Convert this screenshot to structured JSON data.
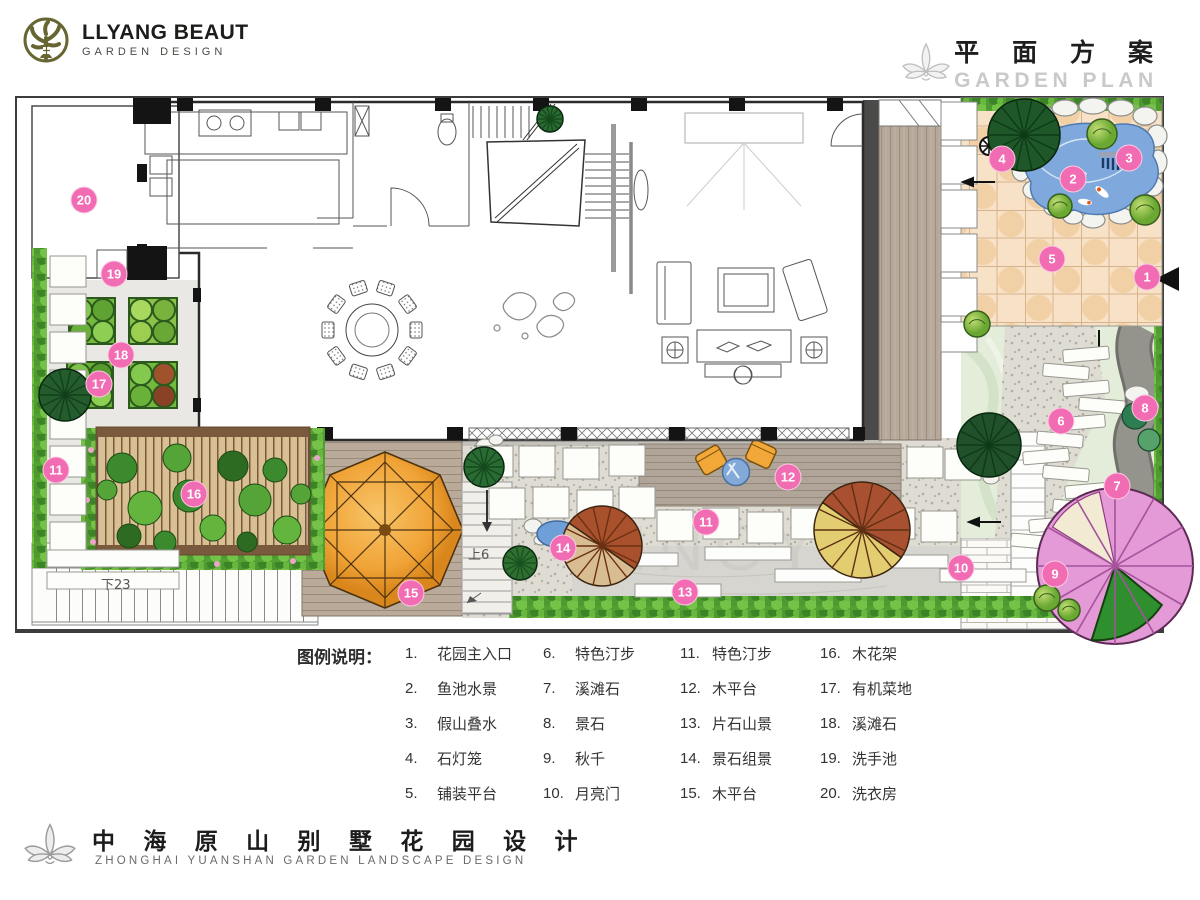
{
  "header": {
    "brand": "LLYANG BEAUT",
    "brand_tagline": "GARDEN DESIGN",
    "title_cn": "平 面 方 案",
    "title_en": "GARDEN PLAN"
  },
  "legend": {
    "heading": "图例说明：",
    "items": [
      {
        "n": "1.",
        "label": "花园主入口"
      },
      {
        "n": "2.",
        "label": "鱼池水景"
      },
      {
        "n": "3.",
        "label": "假山叠水"
      },
      {
        "n": "4.",
        "label": "石灯笼"
      },
      {
        "n": "5.",
        "label": "铺装平台"
      },
      {
        "n": "6.",
        "label": "特色汀步"
      },
      {
        "n": "7.",
        "label": "溪滩石"
      },
      {
        "n": "8.",
        "label": "景石"
      },
      {
        "n": "9.",
        "label": "秋千"
      },
      {
        "n": "10.",
        "label": "月亮门"
      },
      {
        "n": "11.",
        "label": "特色汀步"
      },
      {
        "n": "12.",
        "label": "木平台"
      },
      {
        "n": "13.",
        "label": "片石山景"
      },
      {
        "n": "14.",
        "label": "景石组景"
      },
      {
        "n": "15.",
        "label": "木平台"
      },
      {
        "n": "16.",
        "label": "木花架"
      },
      {
        "n": "17.",
        "label": "有机菜地"
      },
      {
        "n": "18.",
        "label": "溪滩石"
      },
      {
        "n": "19.",
        "label": "洗手池"
      },
      {
        "n": "20.",
        "label": "洗衣房"
      }
    ]
  },
  "plan": {
    "watermark": "XINGYI",
    "accent_color": "#f16cb2",
    "markers": [
      {
        "n": "1",
        "x": 1130,
        "y": 179
      },
      {
        "n": "2",
        "x": 1056,
        "y": 81
      },
      {
        "n": "3",
        "x": 1112,
        "y": 60
      },
      {
        "n": "4",
        "x": 985,
        "y": 61
      },
      {
        "n": "5",
        "x": 1035,
        "y": 161
      },
      {
        "n": "6",
        "x": 1044,
        "y": 323
      },
      {
        "n": "7",
        "x": 1100,
        "y": 388
      },
      {
        "n": "8",
        "x": 1128,
        "y": 310
      },
      {
        "n": "9",
        "x": 1038,
        "y": 476
      },
      {
        "n": "10",
        "x": 944,
        "y": 470
      },
      {
        "n": "11",
        "x": 689,
        "y": 424
      },
      {
        "n": "11",
        "x": 39,
        "y": 372
      },
      {
        "n": "12",
        "x": 771,
        "y": 379
      },
      {
        "n": "13",
        "x": 668,
        "y": 494
      },
      {
        "n": "14",
        "x": 546,
        "y": 450
      },
      {
        "n": "15",
        "x": 394,
        "y": 495
      },
      {
        "n": "16",
        "x": 177,
        "y": 396
      },
      {
        "n": "17",
        "x": 82,
        "y": 286
      },
      {
        "n": "18",
        "x": 104,
        "y": 257
      },
      {
        "n": "19",
        "x": 97,
        "y": 176
      },
      {
        "n": "20",
        "x": 67,
        "y": 102
      }
    ],
    "annotations": [
      {
        "text": "下23",
        "x": 84,
        "y": 476
      },
      {
        "text": "上6",
        "x": 451,
        "y": 446
      }
    ]
  },
  "footer": {
    "title_cn": "中 海 原 山 别 墅 花 园 设 计",
    "title_en": "ZHONGHAI  YUANSHAN  GARDEN  LANDSCAPE  DESIGN"
  }
}
